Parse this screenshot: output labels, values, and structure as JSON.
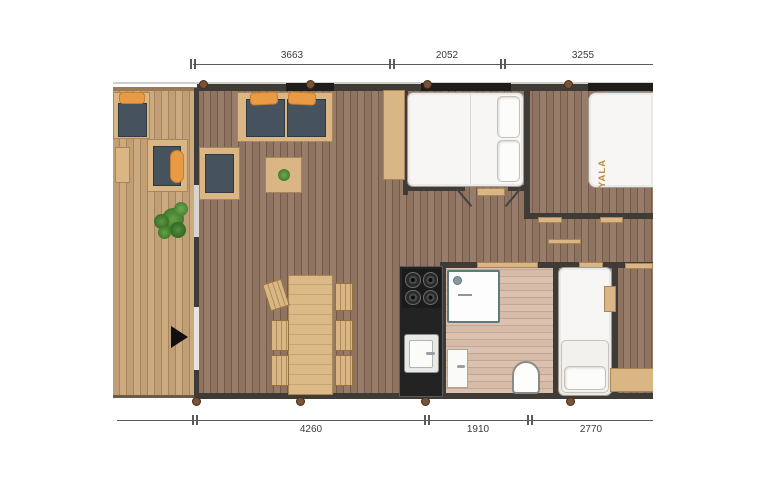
{
  "brand": {
    "bed_label": "YALA"
  },
  "dimensions": {
    "top": [
      {
        "label": "3663"
      },
      {
        "label": "2052"
      },
      {
        "label": "3255"
      }
    ],
    "bottom": [
      {
        "label": "4260"
      },
      {
        "label": "1910"
      },
      {
        "label": "2770"
      }
    ]
  },
  "colors": {
    "deck_wood": "#c29e76",
    "interior_wood": "#8e7361",
    "bathroom_floor": "#dbc2b0",
    "wall": "#3f3c38",
    "furniture_wood": "#d9b684",
    "cushion_slate": "#46525e",
    "accent_orange": "#e89a44",
    "kitchen_black": "#232323",
    "brand_gold": "#b8903f"
  },
  "icons": {
    "entrance_arrow": "right-pointing-triangle",
    "plant": "potted-plant"
  }
}
